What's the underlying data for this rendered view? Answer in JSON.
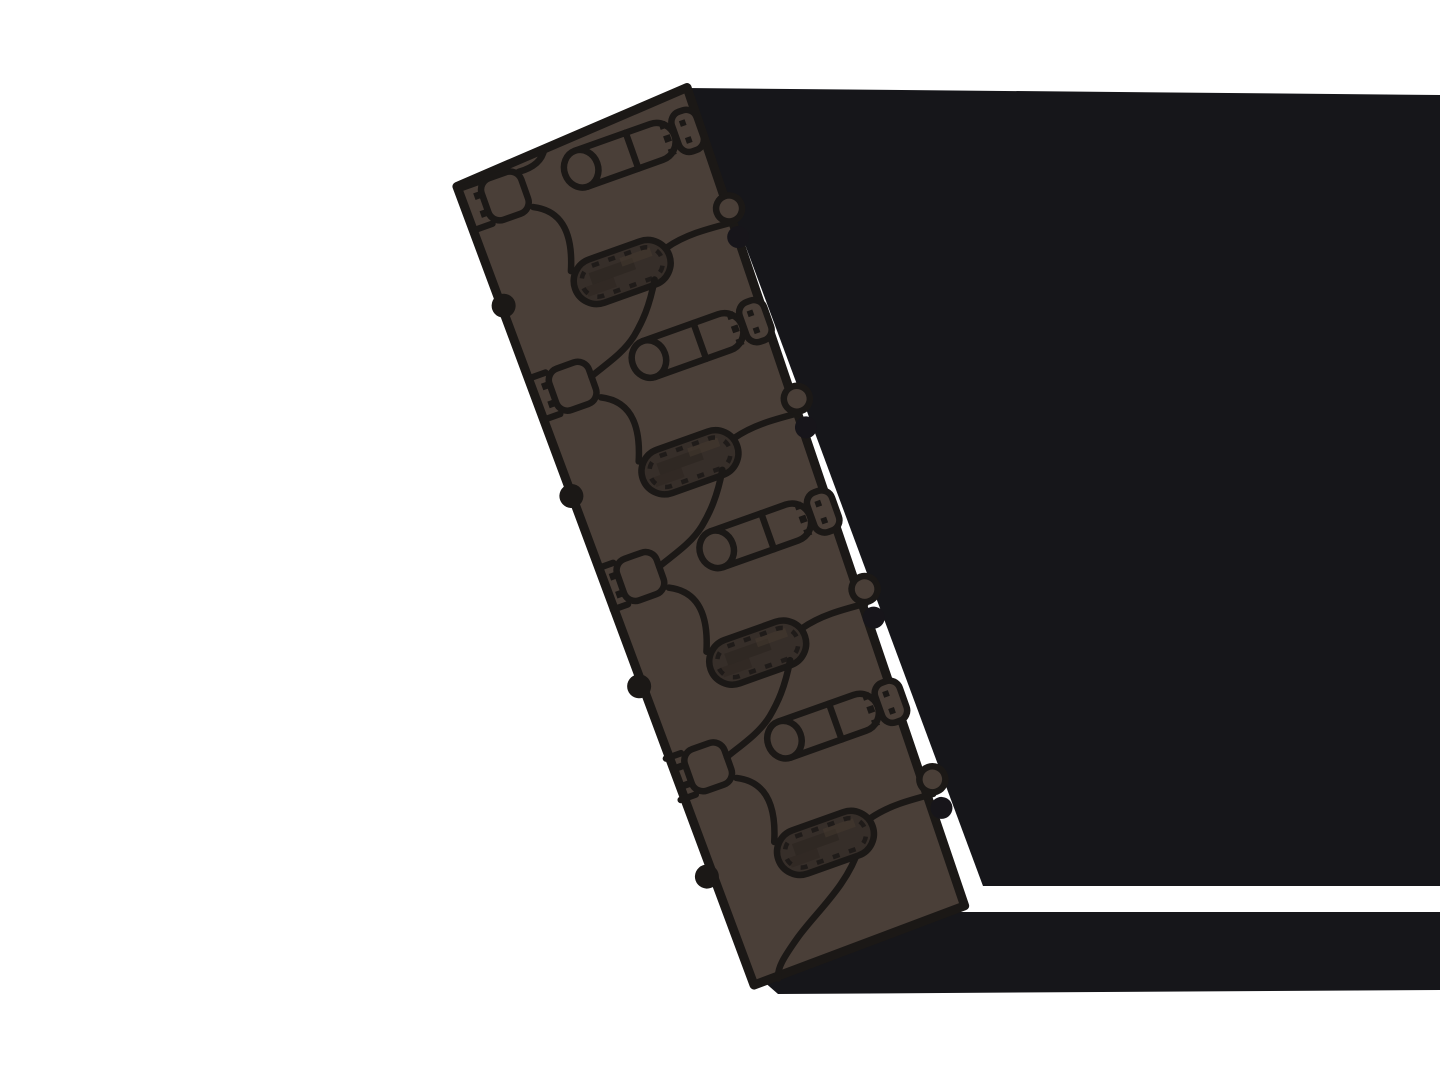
{
  "illustration": {
    "alt": "Stylized technical illustration of an interlocking conveyor-chain / drag-chain belt segment, tilted about 20 degrees, casting a large flat black shadow to the right",
    "canvas": {
      "width": 1440,
      "height": 1080
    },
    "colors": {
      "background": "#ffffff",
      "shadow": "#16161a",
      "outline": "#1b1816",
      "strip_fill": "#4a3f38",
      "slot_fill": "#362e29",
      "slot_noise_dark": "#2b2420",
      "slot_noise_light": "#45392f",
      "notch_fill": "#17151a"
    },
    "shadow_shapes": {
      "main": "M687,88 L1440,95 L1440,886 L983,886 Z",
      "lower_band": "M762,980 L930,912 L1440,912 L1440,990 L778,994 Z"
    },
    "strip": {
      "translate": [
        572,
        137
      ],
      "rotate": -19.6,
      "body_points": "-125,8 125,-8 112,856 -113,860",
      "outline_width": 9,
      "detail_stroke": 6.5,
      "dash_stroke": 4.5
    },
    "links": [
      {
        "pin_y": 33,
        "capsule_y": 144,
        "first": true,
        "last": false
      },
      {
        "pin_y": 235,
        "capsule_y": 346,
        "first": false,
        "last": false
      },
      {
        "pin_y": 437,
        "capsule_y": 548,
        "first": false,
        "last": false
      },
      {
        "pin_y": 639,
        "capsule_y": 750,
        "first": false,
        "last": true
      }
    ],
    "link_parts": {
      "pin_radius": 19,
      "pin_cap_rx": 17,
      "pin_divider_x": 52,
      "capsule_half_length": 50,
      "capsule_half_height": 23,
      "socket": {
        "x": -104,
        "w": 42,
        "h": 44,
        "rx": 12
      },
      "end_piece": {
        "x": 98,
        "w": 26,
        "h": 42,
        "rx": 11
      },
      "left_notch_radius": 12,
      "right_notch_radius": 11,
      "right_bump_radius": 13
    }
  }
}
